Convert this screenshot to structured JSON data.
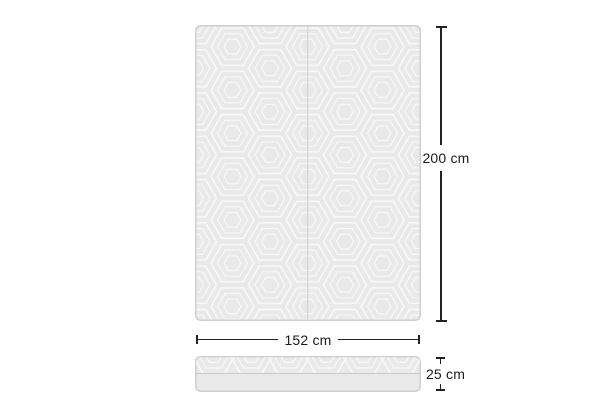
{
  "dimensions": {
    "height": "200 cm",
    "width": "152 cm",
    "depth": "25 cm"
  },
  "colors": {
    "background": "#ffffff",
    "mattress_fill": "#e9e9e9",
    "pattern_line": "#f8f8f8",
    "mattress_border": "#c7c7c7",
    "seam_line": "#cfcfcf",
    "divider_line": "#c9c9c9",
    "dimension_line": "#222222",
    "label_text": "#1b1b1b"
  }
}
